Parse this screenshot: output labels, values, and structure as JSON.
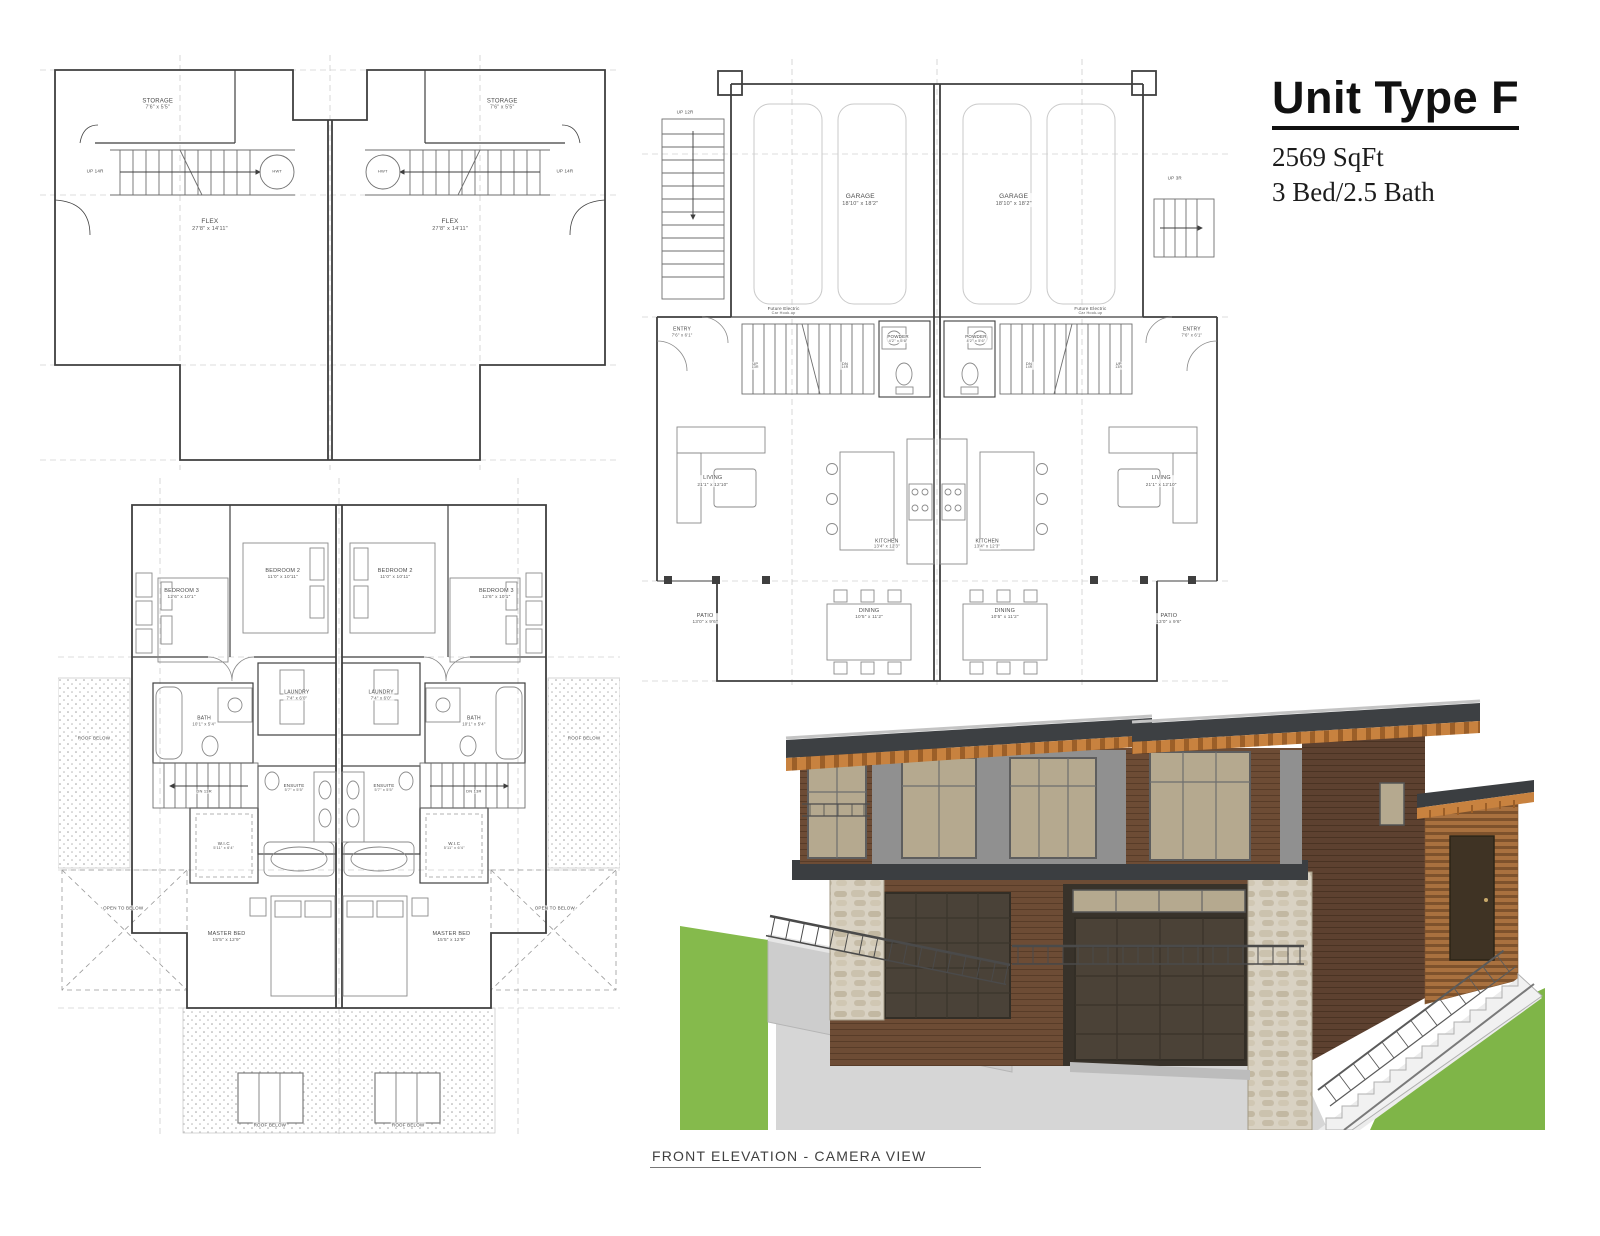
{
  "title": {
    "heading": "Unit Type F",
    "sqft": "2569 SqFt",
    "bedbath": "3 Bed/2.5 Bath"
  },
  "caption": "FRONT ELEVATION - CAMERA VIEW",
  "colors": {
    "siding_brown": "#6d4c35",
    "siding_side": "#5d4130",
    "rafter_orange": "#c8823f",
    "fascia_dark": "#3b3e41",
    "panel_gray": "#909090",
    "glass_beige": "#b5a98f",
    "stone_light": "#d9d2c3",
    "garage_door": "#4a4238",
    "concrete": "#d6d6d6",
    "grass_green": "#7fb548",
    "plan_line": "#3f3f3f"
  },
  "plans": {
    "basement": {
      "labels": [
        {
          "t": "STORAGE",
          "d": "7'6\" x 5'5\"",
          "x": 20.3,
          "y": 12,
          "fs": 6
        },
        {
          "t": "STORAGE",
          "d": "7'6\" x 5'5\"",
          "x": 79.7,
          "y": 12,
          "fs": 6
        },
        {
          "t": "UP 14R",
          "x": 9.5,
          "y": 28,
          "fs": 4.5
        },
        {
          "t": "UP 14R",
          "x": 90.5,
          "y": 28,
          "fs": 4.5
        },
        {
          "t": "HWT",
          "x": 40.9,
          "y": 28.2,
          "fs": 4
        },
        {
          "t": "HWT",
          "x": 59.1,
          "y": 28.2,
          "fs": 4
        },
        {
          "t": "FLEX",
          "d": "27'8\" x 14'11\"",
          "x": 29.3,
          "y": 41,
          "fs": 6.5
        },
        {
          "t": "FLEX",
          "d": "27'8\" x 14'11\"",
          "x": 70.7,
          "y": 41,
          "fs": 6.5
        }
      ]
    },
    "main": {
      "labels": [
        {
          "t": "GARAGE",
          "d": "18'10\" x 18'2\"",
          "x": 37,
          "y": 22.5,
          "fs": 6.5
        },
        {
          "t": "GARAGE",
          "d": "18'10\" x 18'2\"",
          "x": 63,
          "y": 22.5,
          "fs": 6.5
        },
        {
          "t": "UP 12R",
          "x": 7.3,
          "y": 8.5,
          "fs": 4.5
        },
        {
          "t": "UP 3R",
          "x": 90.3,
          "y": 19,
          "fs": 4.5
        },
        {
          "t": "Future Electric",
          "d": "Car Hook-up",
          "x": 24,
          "y": 40,
          "fs": 4.5
        },
        {
          "t": "Future Electric",
          "d": "Car Hook-up",
          "x": 76,
          "y": 40,
          "fs": 4.5
        },
        {
          "t": "ENTRY",
          "d": "7'6\" x 6'1\"",
          "x": 6.8,
          "y": 43.5,
          "fs": 5
        },
        {
          "t": "ENTRY",
          "d": "7'6\" x 6'1\"",
          "x": 93.2,
          "y": 43.5,
          "fs": 5
        },
        {
          "t": "POWDER",
          "d": "4'2\" x 5'6\"",
          "x": 43.4,
          "y": 44.4,
          "fs": 4.5
        },
        {
          "t": "POWDER",
          "d": "4'2\" x 5'6\"",
          "x": 56.6,
          "y": 44.4,
          "fs": 4.5
        },
        {
          "t": "UP",
          "d": "13R",
          "x": 19.2,
          "y": 48.7,
          "fs": 4
        },
        {
          "t": "DN",
          "d": "14R",
          "x": 34.4,
          "y": 48.7,
          "fs": 4
        },
        {
          "t": "DN",
          "d": "14R",
          "x": 65.6,
          "y": 48.7,
          "fs": 4
        },
        {
          "t": "UP",
          "d": "13R",
          "x": 80.8,
          "y": 48.7,
          "fs": 4
        },
        {
          "t": "LIVING",
          "d": "21'1\" x 12'10\"",
          "x": 12,
          "y": 67,
          "fs": 5.5
        },
        {
          "t": "LIVING",
          "d": "21'1\" x 12'10\"",
          "x": 88,
          "y": 67,
          "fs": 5.5
        },
        {
          "t": "KITCHEN",
          "d": "13'4\" x 12'3\"",
          "x": 41.5,
          "y": 77,
          "fs": 5
        },
        {
          "t": "KITCHEN",
          "d": "13'4\" x 12'3\"",
          "x": 58.5,
          "y": 77,
          "fs": 5
        },
        {
          "t": "DINING",
          "d": "10'5\" x 11'2\"",
          "x": 38.5,
          "y": 88,
          "fs": 5.5
        },
        {
          "t": "DINING",
          "d": "10'5\" x 11'2\"",
          "x": 61.5,
          "y": 88,
          "fs": 5.5
        },
        {
          "t": "PATIO",
          "d": "13'0\" x 9'6\"",
          "x": 10.7,
          "y": 88.7,
          "fs": 5.5
        },
        {
          "t": "PATIO",
          "d": "13'0\" x 9'6\"",
          "x": 89.3,
          "y": 88.7,
          "fs": 5.5
        }
      ]
    },
    "upper": {
      "labels": [
        {
          "t": "BEDROOM 2",
          "d": "11'0\" x 10'11\"",
          "x": 40,
          "y": 14.5,
          "fs": 5.5
        },
        {
          "t": "BEDROOM 2",
          "d": "11'0\" x 10'11\"",
          "x": 60,
          "y": 14.5,
          "fs": 5.5
        },
        {
          "t": "BEDROOM 3",
          "d": "12'6\" x 10'1\"",
          "x": 22,
          "y": 17.5,
          "fs": 5.5
        },
        {
          "t": "BEDROOM 3",
          "d": "12'6\" x 10'1\"",
          "x": 78,
          "y": 17.5,
          "fs": 5.5
        },
        {
          "t": "LAUNDRY",
          "d": "7'4\" x 6'0\"",
          "x": 42.5,
          "y": 33,
          "fs": 5
        },
        {
          "t": "LAUNDRY",
          "d": "7'4\" x 6'0\"",
          "x": 57.5,
          "y": 33,
          "fs": 5
        },
        {
          "t": "BATH",
          "d": "10'1\" x 5'4\"",
          "x": 26,
          "y": 37,
          "fs": 5
        },
        {
          "t": "BATH",
          "d": "10'1\" x 5'4\"",
          "x": 74,
          "y": 37,
          "fs": 5
        },
        {
          "t": "ROOF BELOW",
          "x": 6.4,
          "y": 39.4,
          "fs": 4.5
        },
        {
          "t": "ROOF BELOW",
          "x": 93.6,
          "y": 39.4,
          "fs": 4.5
        },
        {
          "t": "DN 13R",
          "x": 26,
          "y": 47.5,
          "fs": 4
        },
        {
          "t": "DN 13R",
          "x": 74,
          "y": 47.5,
          "fs": 4
        },
        {
          "t": "ENSUITE",
          "d": "5'7\" x 5'5\"",
          "x": 42,
          "y": 47,
          "fs": 4.5
        },
        {
          "t": "ENSUITE",
          "d": "5'7\" x 5'5\"",
          "x": 58,
          "y": 47,
          "fs": 4.5
        },
        {
          "t": "W.I.C",
          "d": "5'11\" x 6'4\"",
          "x": 29.5,
          "y": 55.8,
          "fs": 4.5
        },
        {
          "t": "W.I.C",
          "d": "5'11\" x 6'4\"",
          "x": 70.5,
          "y": 55.8,
          "fs": 4.5
        },
        {
          "t": "OPEN TO BELOW",
          "x": 11.6,
          "y": 65.2,
          "fs": 4.5
        },
        {
          "t": "OPEN TO BELOW",
          "x": 88.4,
          "y": 65.2,
          "fs": 4.5
        },
        {
          "t": "MASTER BED",
          "d": "15'5\" x 12'9\"",
          "x": 30,
          "y": 69.5,
          "fs": 5.5
        },
        {
          "t": "MASTER BED",
          "d": "15'5\" x 12'9\"",
          "x": 70,
          "y": 69.5,
          "fs": 5.5
        },
        {
          "t": "ROOF BELOW",
          "x": 37.7,
          "y": 98,
          "fs": 4.5
        },
        {
          "t": "ROOF BELOW",
          "x": 62.3,
          "y": 98,
          "fs": 4.5
        }
      ]
    }
  }
}
